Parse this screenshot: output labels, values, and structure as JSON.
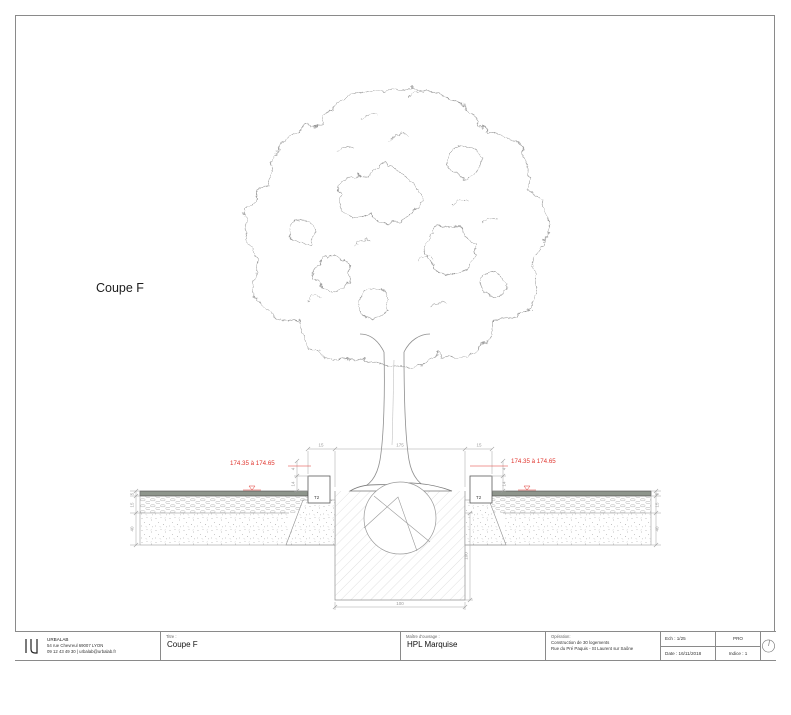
{
  "sheet": {
    "view_label": "Coupe F"
  },
  "drawing": {
    "level_left": "174.35 à 174.65",
    "level_right": "174.35 à 174.65",
    "kerb_left": "T2",
    "kerb_right": "T2",
    "dims": {
      "top_left": "15",
      "top_center": "175",
      "top_right": "15",
      "layer_surface_l": "5",
      "layer_base_l": "15",
      "layer_sub_l": "40",
      "layer_surface_r": "5",
      "layer_base_r": "15",
      "layer_sub_r": "40",
      "kerb_top_l": "4",
      "kerb_bottom_l": "14",
      "kerb_top_r": "4",
      "kerb_bottom_r": "14",
      "pit_depth": "100",
      "pit_width": "100"
    },
    "colors": {
      "annotation_red": "#e0352e",
      "surface_layer": "#8e958c",
      "line_gray": "#9a9a9a"
    }
  },
  "titleblock": {
    "company": {
      "logo": "IJ",
      "name": "URBALAB",
      "address": "54 rue Chevreul 69007 LYON",
      "contact": "09 12 43 49 30 | urbalab@urbalab.fr"
    },
    "title": {
      "label": "Titre :",
      "value": "Coupe F"
    },
    "client": {
      "label": "Maître d'ouvrage :",
      "value": "HPL Marquise"
    },
    "operation": {
      "label": "Opération:",
      "line1": "Construction de 30 logements",
      "line2": "Rue du Pré Paquis - St Laurent sur Saône"
    },
    "scale": "Ech : 1/25",
    "date": "Date : 16/11/2018",
    "phase": "PRO",
    "index_label": "Indice : 1"
  }
}
